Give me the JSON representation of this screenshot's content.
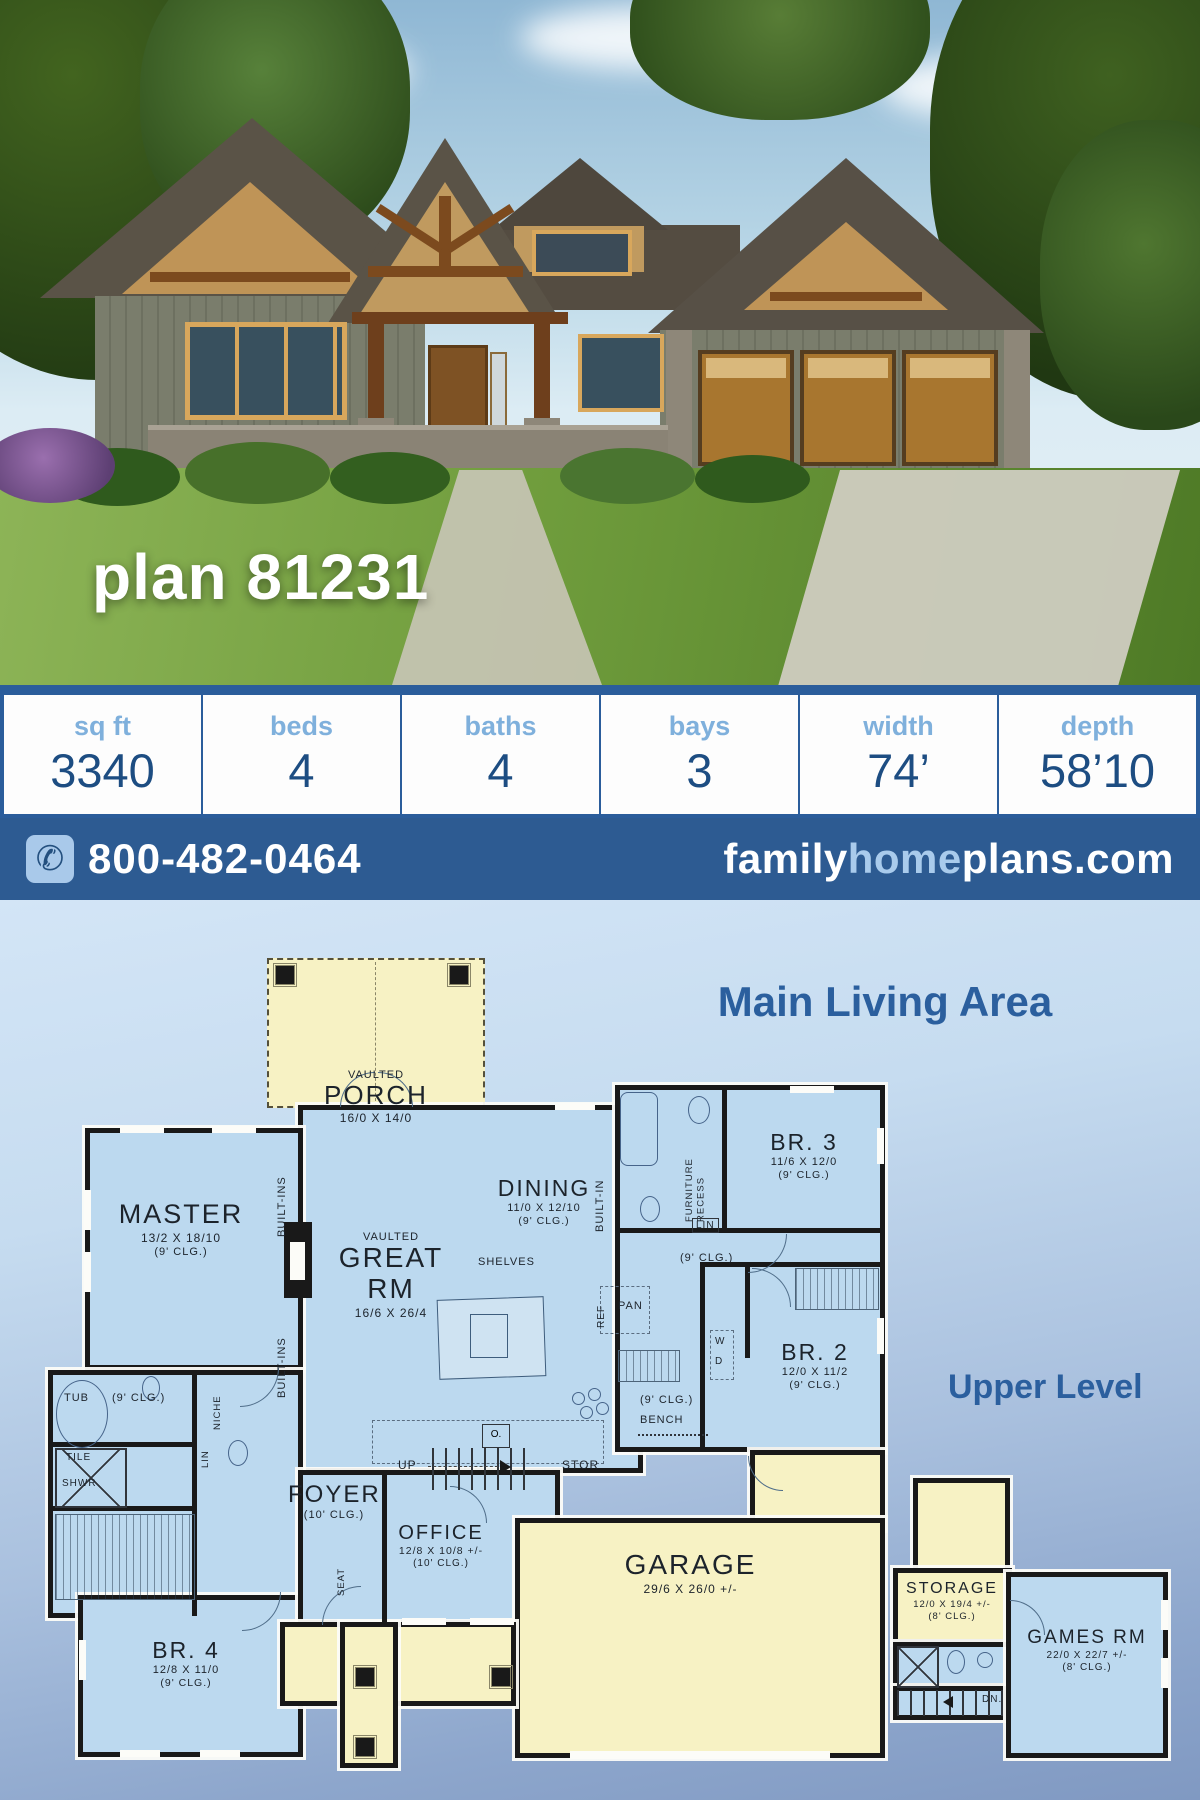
{
  "hero": {
    "plan_title": "plan 81231"
  },
  "stats": {
    "columns": [
      {
        "label": "sq ft",
        "value": "3340"
      },
      {
        "label": "beds",
        "value": "4"
      },
      {
        "label": "baths",
        "value": "4"
      },
      {
        "label": "bays",
        "value": "3"
      },
      {
        "label": "width",
        "value": "74’"
      },
      {
        "label": "depth",
        "value": "58’10"
      }
    ]
  },
  "contact": {
    "phone": "800-482-0464",
    "site_family": "family",
    "site_home": "home",
    "site_plans": "plans.com"
  },
  "colors": {
    "accent_blue": "#2b5d9b",
    "label_light_blue": "#7fb0dc",
    "value_navy": "#1d4d82",
    "bar_blue": "#2d5b92",
    "room_blue": "#bcd9ef",
    "room_yellow": "#f7f2c4",
    "wall_black": "#191919",
    "title_blue": "#2b5f9e"
  },
  "floorplan": {
    "main_title": "Main Living Area",
    "upper_title": "Upper Level",
    "rooms": {
      "porch": {
        "prefix": "VAULTED",
        "name": "PORCH",
        "dims": "16/0 X 14/0"
      },
      "master": {
        "name": "MASTER",
        "dims": "13/2 X 18/10",
        "clg": "(9' CLG.)"
      },
      "great": {
        "prefix": "VAULTED",
        "name": "GREAT RM",
        "dims": "16/6 X 26/4"
      },
      "dining": {
        "name": "DINING",
        "dims": "11/0 X 12/10",
        "clg": "(9' CLG.)"
      },
      "br3": {
        "name": "BR. 3",
        "dims": "11/6 X 12/0",
        "clg": "(9' CLG.)"
      },
      "br2": {
        "name": "BR. 2",
        "dims": "12/0 X 11/2",
        "clg": "(9' CLG.)"
      },
      "br4": {
        "name": "BR. 4",
        "dims": "12/8 X 11/0",
        "clg": "(9' CLG.)"
      },
      "office": {
        "name": "OFFICE",
        "dims": "12/8 X 10/8 +/-",
        "clg": "(10' CLG.)"
      },
      "foyer": {
        "name": "FOYER",
        "clg": "(10' CLG.)"
      },
      "garage": {
        "name": "GARAGE",
        "dims": "29/6 X 26/0 +/-"
      },
      "storage": {
        "name": "STORAGE",
        "dims": "12/0 X 19/4 +/-",
        "clg": "(8' CLG.)"
      },
      "games": {
        "name": "GAMES RM",
        "dims": "22/0 X 22/7 +/-",
        "clg": "(8' CLG.)"
      }
    },
    "annotations": {
      "built_ins_a": "BUILT-INS",
      "built_ins_b": "BUILT-INS",
      "built_in": "BUILT-IN",
      "furn_recess": "FURNITURE RECESS",
      "lin_a": "LIN",
      "lin_b": "LIN",
      "niche": "NICHE",
      "shelves": "SHELVES",
      "ref": "REF",
      "pan": "PAN",
      "w": "W",
      "d": "D",
      "bench": "BENCH",
      "clg9_hall": "(9' CLG.)",
      "clg9_mud": "(9' CLG.)",
      "clg9_bath": "(9' CLG.)",
      "tub": "TUB",
      "tile": "TILE",
      "shwr": "SHWR",
      "seat": "SEAT",
      "up": "UP",
      "stor": "STOR",
      "dn": "DN.",
      "oven": "O."
    }
  }
}
